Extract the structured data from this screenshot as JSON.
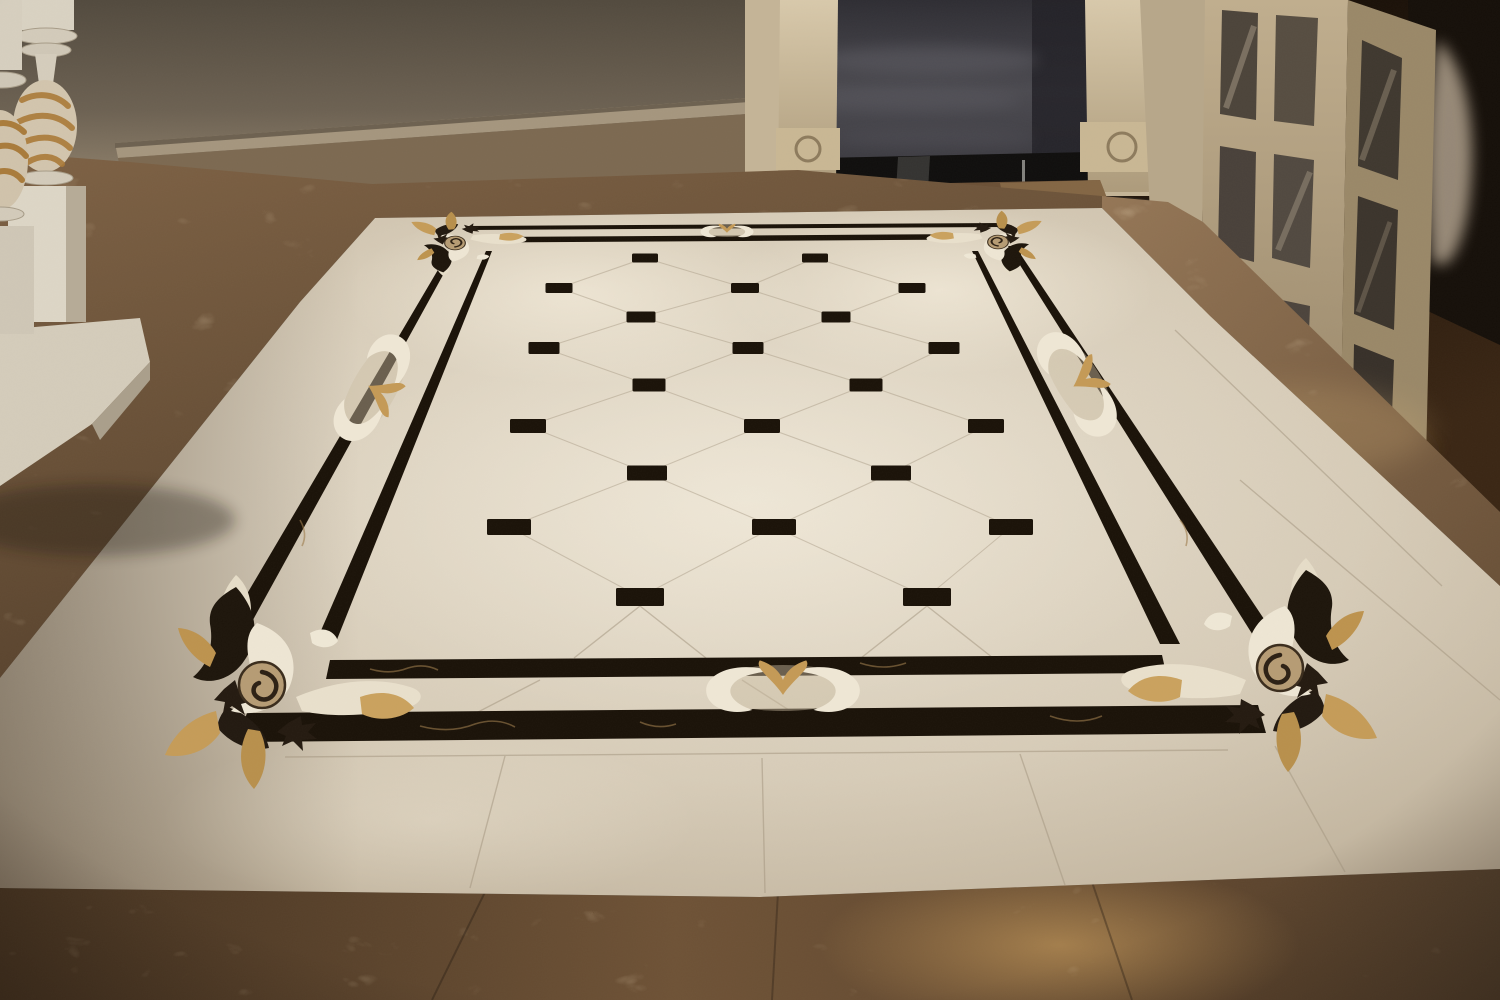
{
  "scene": {
    "type": "interior-photograph",
    "subject": "Luxury foyer with crema-marfil marble floor, black waterjet inlay carpet border, scroll corner medallions, diamond dot field",
    "areas": {
      "wall": "taupe plaster wall with stone chair-rail and marble baseboard",
      "staircase": "white turned newel balusters with gilded acanthus carving on square plinth",
      "doorway": "dark stair opening flanked by carved beige pilasters over a glossy black base",
      "french_doors": "open glazed double doors, dark room and curtain highlight behind, dark wood floor",
      "floor_perimeter": "dark emperador marble band around the field and across the foreground",
      "floor_field": "cream marble tiles laid diagonally with small black square insets",
      "carpet_inlay": "double black marble line border with gold-veined portoro, corner and mid-side scroll ornaments"
    }
  },
  "palette": {
    "wall_top": "#584e41",
    "wall_bottom": "#978871",
    "molding": "#a5967e",
    "baseboard_stone": "#7c6951",
    "outlet": "#241c12",
    "pedestal": "#d8d1c1",
    "pedestal_shadow": "#b3a894",
    "gold_carving": "#ab7a38",
    "pilaster": "#cfc0a1",
    "pilaster_shadow": "#9f8d6d",
    "doorway_wall": "#46454b",
    "doorway_dark": "#26252b",
    "glossy_base": "#0f0e0d",
    "wood": "#20150b",
    "door_frame": "#b3a183",
    "door_frame_shadow": "#8d7b5e",
    "glass": "#4c443a",
    "glass_streak": "#cfc0a8",
    "dark_room": "#150f09",
    "curtain": "#b7a793",
    "brown_band": "#6e5439",
    "brown_dark": "#43311f",
    "tan_band": "#8a6c4b",
    "apron_glow": "#d8a963",
    "cream": "#d5cab6",
    "cream_bright": "#eae2d2",
    "cream_shadow": "#af9f8a",
    "inlay_black": "#1a1208",
    "inlay_vein": "#9c7b4b",
    "ornament_white": "#ece4d1",
    "ornament_gold": "#c49a56",
    "spiral_tan": "#b69c74",
    "grout": "#a59781"
  },
  "carpet": {
    "lattice_max_dx": 200,
    "dot_rows": [
      {
        "y": 258,
        "h": 9,
        "dots": [
          {
            "x": 645,
            "w": 26
          },
          {
            "x": 815,
            "w": 26
          }
        ]
      },
      {
        "y": 288,
        "h": 10,
        "dots": [
          {
            "x": 559,
            "w": 27
          },
          {
            "x": 745,
            "w": 28
          },
          {
            "x": 912,
            "w": 27
          }
        ]
      },
      {
        "y": 317,
        "h": 11,
        "dots": [
          {
            "x": 641,
            "w": 29
          },
          {
            "x": 836,
            "w": 29
          }
        ]
      },
      {
        "y": 348,
        "h": 12,
        "dots": [
          {
            "x": 544,
            "w": 31
          },
          {
            "x": 748,
            "w": 31
          },
          {
            "x": 944,
            "w": 31
          }
        ]
      },
      {
        "y": 385,
        "h": 13,
        "dots": [
          {
            "x": 649,
            "w": 33
          },
          {
            "x": 866,
            "w": 33
          }
        ]
      },
      {
        "y": 426,
        "h": 14,
        "dots": [
          {
            "x": 528,
            "w": 36
          },
          {
            "x": 762,
            "w": 36
          },
          {
            "x": 986,
            "w": 36
          }
        ]
      },
      {
        "y": 473,
        "h": 15,
        "dots": [
          {
            "x": 647,
            "w": 40
          },
          {
            "x": 891,
            "w": 40
          }
        ]
      },
      {
        "y": 527,
        "h": 16,
        "dots": [
          {
            "x": 509,
            "w": 44
          },
          {
            "x": 774,
            "w": 44
          },
          {
            "x": 1011,
            "w": 44
          }
        ]
      },
      {
        "y": 597,
        "h": 18,
        "dots": [
          {
            "x": 640,
            "w": 48
          },
          {
            "x": 927,
            "w": 48
          }
        ]
      }
    ]
  }
}
